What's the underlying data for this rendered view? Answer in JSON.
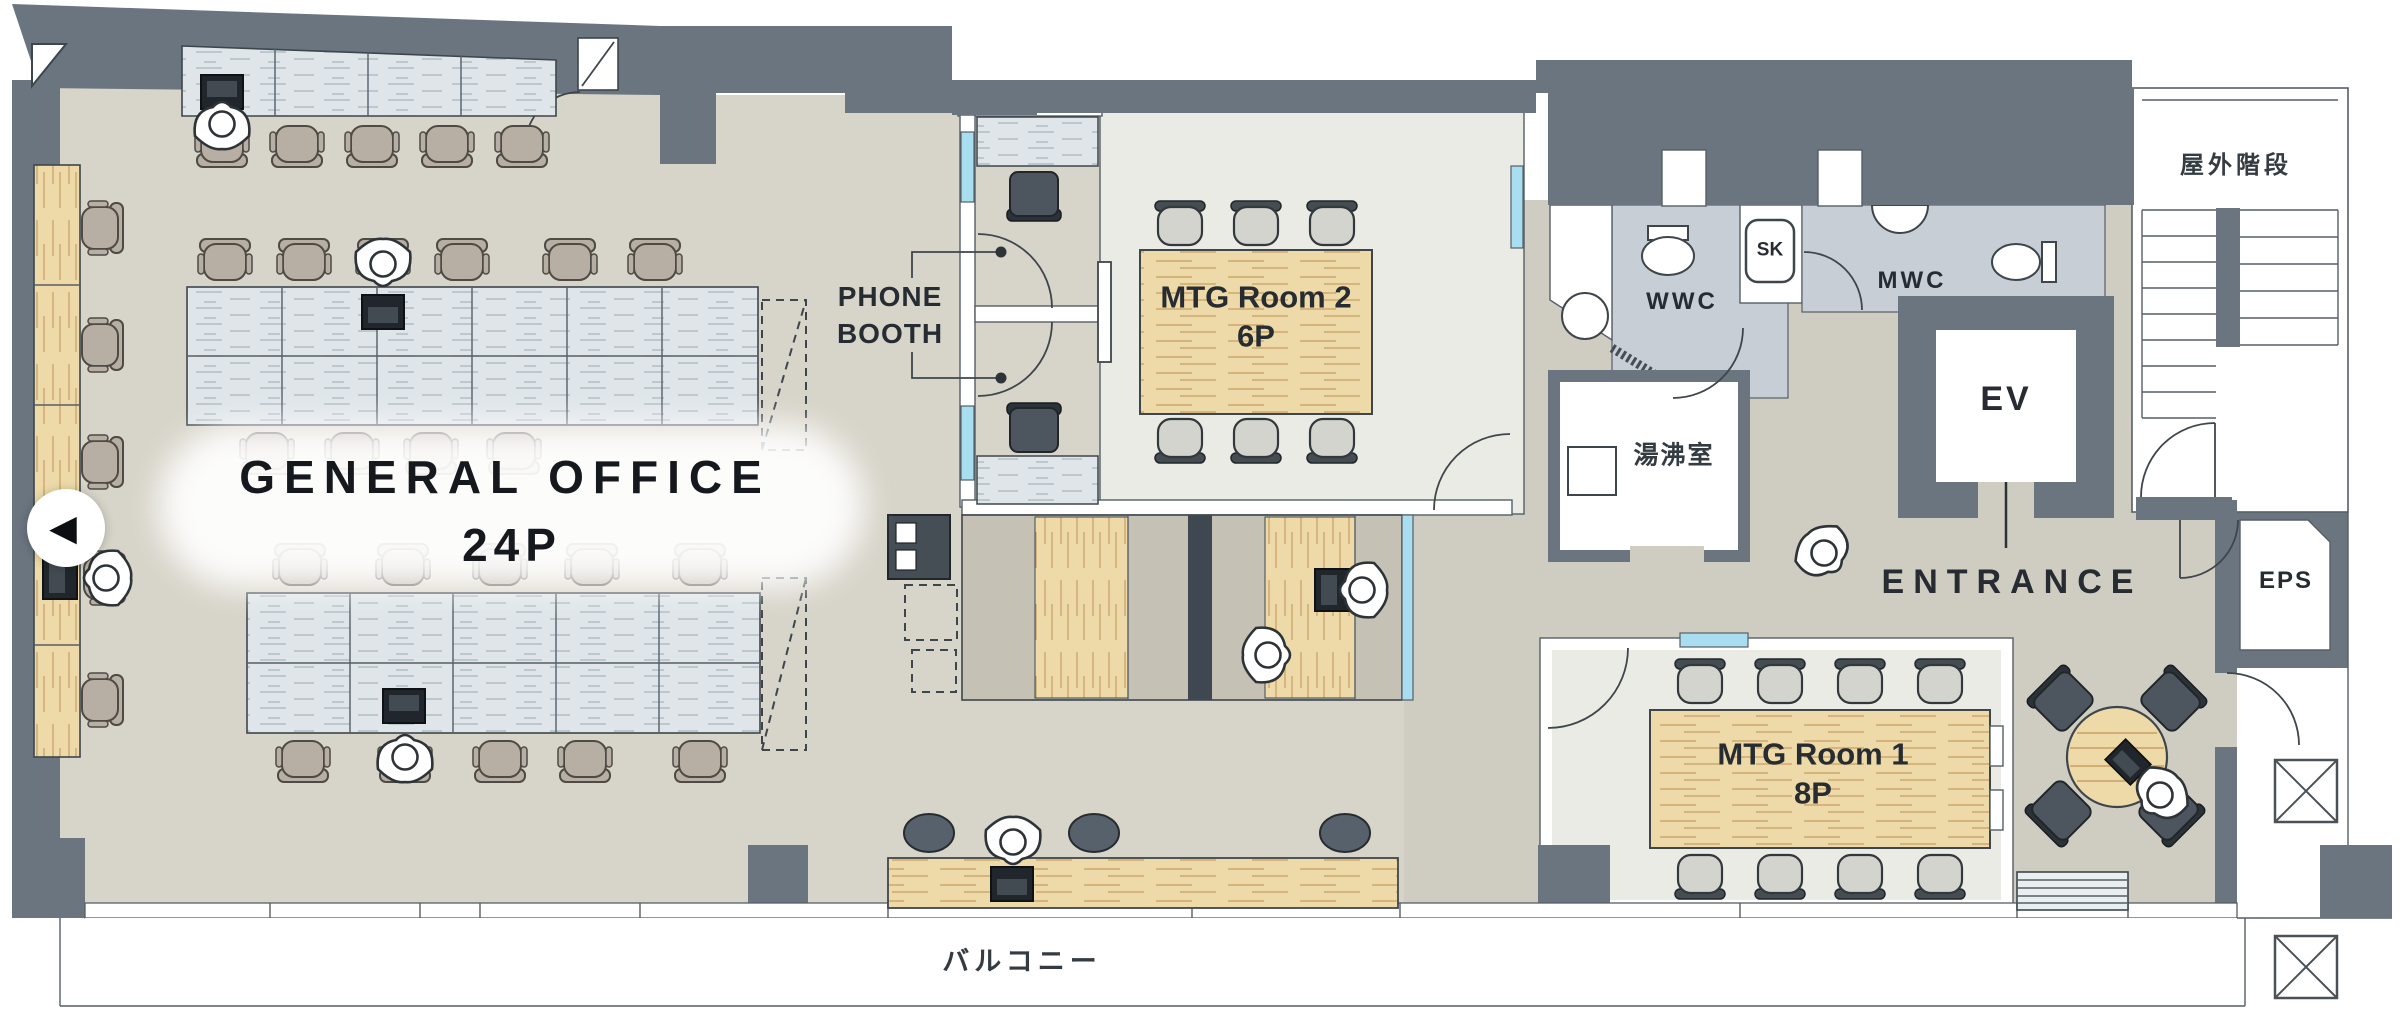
{
  "floorplan": {
    "title": {
      "line1": "GENERAL OFFICE",
      "line2": "24P"
    },
    "rooms": {
      "phone_booth": {
        "line1": "PHONE",
        "line2": "BOOTH"
      },
      "mtg_room_2": {
        "name": "MTG Room 2",
        "capacity": "6P"
      },
      "mtg_room_1": {
        "name": "MTG Room 1",
        "capacity": "8P"
      },
      "wwc": "WWC",
      "sk": "SK",
      "mwc": "MWC",
      "hot_water_room": "湯沸室",
      "elevator": "EV",
      "entrance": "ENTRANCE",
      "eps": "EPS",
      "outdoor_stairs": "屋外階段",
      "balcony": "バルコニー"
    },
    "nav": {
      "back_icon": "◀"
    },
    "colors": {
      "wall": "#6a7580",
      "office_floor": "#d7d4c9",
      "hall_floor": "#cfccc1",
      "meeting_floor": "#ebebe5",
      "wc_floor": "#c8ced5",
      "wood": "#eedaa8",
      "desk": "#dfe5e9",
      "glass": "#a9ddf0",
      "dark_seat": "#4d565e",
      "text": "#262c31"
    }
  }
}
